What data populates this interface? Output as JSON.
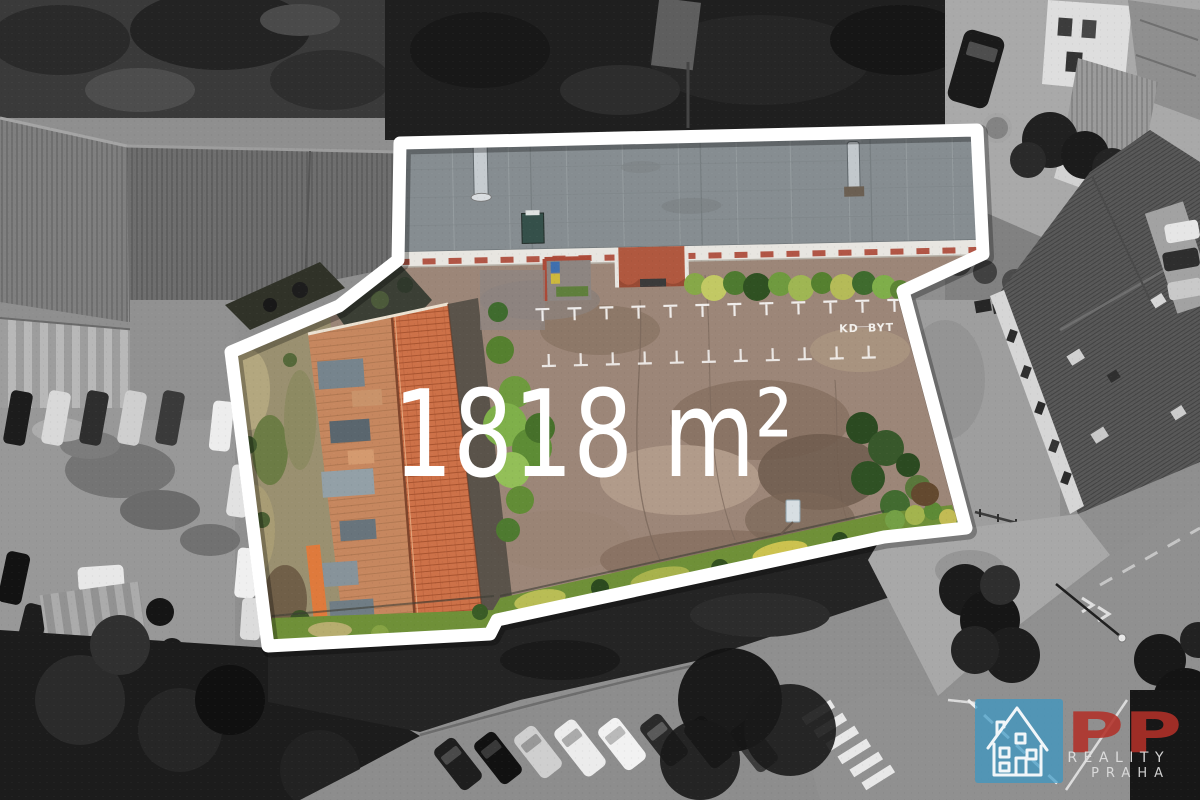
{
  "photo": {
    "description": "aerial drone view of property plot with selective color highlight",
    "outline_color": "#ffffff"
  },
  "overlay": {
    "area_label": "1818 m²"
  },
  "ground_markings": {
    "label_left": "KD",
    "label_right": "BYT"
  },
  "logo": {
    "monogram": "PP",
    "line1": "REALITY",
    "line2": "PRAHA",
    "monogram_color": "#b23129",
    "square_color": "#3a97c4",
    "icon": "house-outline-icon"
  }
}
